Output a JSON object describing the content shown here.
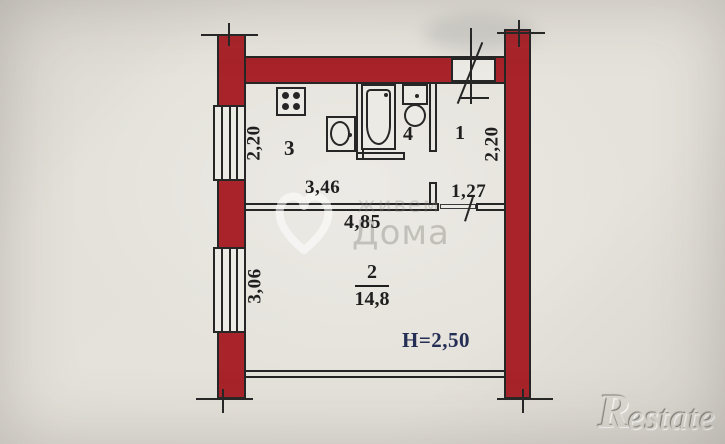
{
  "plan": {
    "rooms": [
      {
        "label": "3"
      },
      {
        "label": "4"
      },
      {
        "label": "1"
      },
      {
        "label": "2",
        "area": "14,8"
      }
    ],
    "dimensions": {
      "kitchen_window": "2,20",
      "hall_depth": "2,20",
      "kitchen_width": "3,46",
      "hall_width": "1,27",
      "total_width": "4,85",
      "room2_window": "3,06",
      "ceiling_height": "H=2,50"
    },
    "colors": {
      "wall_red": "#a8232a",
      "line": "#262626",
      "paper_light": "#eceae4",
      "height_label": "#252e55",
      "watermark": "#8c8a82"
    }
  },
  "watermark": {
    "line1": "живем",
    "line2": "Дома"
  },
  "logo": {
    "letter": "R",
    "rest": "estate"
  }
}
